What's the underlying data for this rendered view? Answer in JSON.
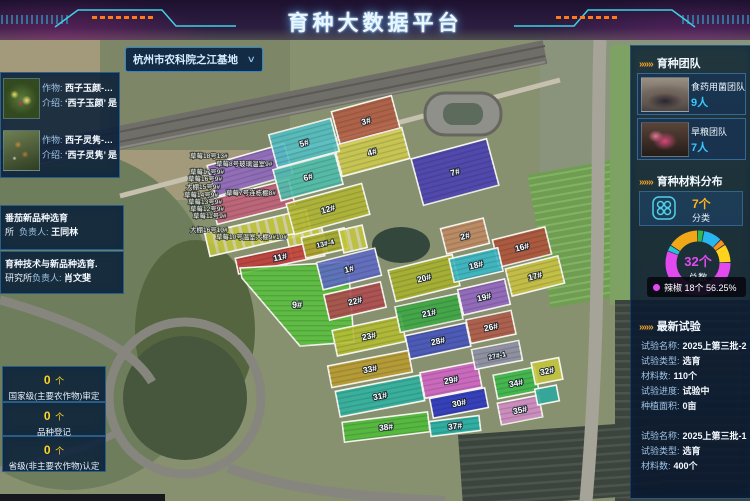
{
  "header": {
    "title": "育种大数据平台"
  },
  "base_selector": {
    "value": "杭州市农科院之江基地",
    "chevron": "∨"
  },
  "icons": {
    "section_marker": "»»»"
  },
  "left": {
    "crops": [
      {
        "crop_label": "作物:",
        "name": "西子玉颜-…",
        "intro_label": "介绍:",
        "intro": "‘西子玉颜’ 是…"
      },
      {
        "crop_label": "作物:",
        "name": "西子灵隽-…",
        "intro_label": "介绍:",
        "intro": "‘西子灵隽’ 是…"
      }
    ],
    "projects": [
      {
        "title": "番茄新品种选育",
        "org": "所",
        "leader_label": "负责人:",
        "leader": "王同林"
      },
      {
        "title": "育种技术与新品种选育.",
        "org": "研究所",
        "leader_label": "负责人:",
        "leader": "肖文斐"
      }
    ],
    "stats": [
      {
        "value": "0",
        "unit": "个",
        "label": "国家级(主要农作物)审定"
      },
      {
        "value": "0",
        "unit": "个",
        "label": "品种登记"
      },
      {
        "value": "0",
        "unit": "个",
        "label": "省级(非主要农作物)认定"
      }
    ]
  },
  "right": {
    "teams": {
      "title": "育种团队",
      "items": [
        {
          "name": "食药用菌团队",
          "count": "9人"
        },
        {
          "name": "旱粮团队",
          "count": "7人"
        }
      ]
    },
    "materials": {
      "title": "育种材料分布",
      "categories_count": "7个",
      "categories_label": "分类",
      "total": "32个",
      "total_label": "总数",
      "tooltip_text": "辣椒 18个  56.25%"
    },
    "experiments": {
      "title": "最新试验",
      "items": [
        {
          "fields": [
            {
              "l": "试验名称:",
              "v": "2025上第三批-2"
            },
            {
              "l": "试验类型:",
              "v": "选育"
            },
            {
              "l": "材料数:",
              "v": "110个"
            },
            {
              "l": "试验进度:",
              "v": "试验中"
            },
            {
              "l": "种植面积:",
              "v": "0亩"
            }
          ]
        },
        {
          "fields": [
            {
              "l": "试验名称:",
              "v": "2025上第三批-1"
            },
            {
              "l": "试验类型:",
              "v": "选育"
            },
            {
              "l": "材料数:",
              "v": "400个"
            }
          ]
        }
      ]
    }
  },
  "chart_data": {
    "type": "pie",
    "title": "育种材料分布",
    "total": 32,
    "total_label": "总数",
    "categories_count": 7,
    "legend_position": "tooltip-only",
    "segments": [
      {
        "name": "",
        "value": 1,
        "color": "#2eb84d"
      },
      {
        "name": "",
        "value": 3,
        "color": "#29b5f0"
      },
      {
        "name": "",
        "value": 1,
        "color": "#f7931e"
      },
      {
        "name": "",
        "value": 3,
        "color": "#ffd21e"
      },
      {
        "name": "辣椒",
        "value": 18,
        "color": "#e24af0",
        "percent": "56.25%"
      },
      {
        "name": "",
        "value": 1,
        "color": "#29c0d8"
      },
      {
        "name": "",
        "value": 5,
        "color": "#f0a818"
      }
    ]
  },
  "map": {
    "parcels": [
      {
        "id": "greenhouse-purple",
        "x": 250,
        "y": 170,
        "w": 80,
        "h": 32,
        "r": -16,
        "c": "#9068c0",
        "l": ""
      },
      {
        "id": "greenhouse-pink",
        "x": 253,
        "y": 202,
        "w": 80,
        "h": 26,
        "r": -14,
        "c": "#c4607c",
        "l": ""
      },
      {
        "id": "strip-beds-a",
        "x": 258,
        "y": 233,
        "w": 104,
        "h": 24,
        "r": -13,
        "c": "strips",
        "l": ""
      },
      {
        "id": "strip-beds-c",
        "x": 307,
        "y": 244,
        "w": 36,
        "h": 26,
        "r": -13,
        "c": "strips",
        "l": ""
      },
      {
        "id": "p11",
        "x": 280,
        "y": 257,
        "w": 88,
        "h": 16,
        "r": -12,
        "c": "#c23b3b",
        "l": "11#"
      },
      {
        "id": "p9",
        "poly": "240,268 348,262 354,342 300,346 242,278",
        "c": "#57c23c",
        "l": "9#",
        "lx": 297,
        "ly": 308
      },
      {
        "id": "p12",
        "x": 328,
        "y": 209,
        "w": 78,
        "h": 32,
        "r": -15,
        "c": "#b3b733",
        "l": "12#"
      },
      {
        "id": "p13-4",
        "x": 325,
        "y": 243,
        "w": 44,
        "h": 21,
        "r": -13,
        "c": "#a8ad2e",
        "l": "13#-4"
      },
      {
        "id": "strip-beds-d",
        "x": 353,
        "y": 239,
        "w": 24,
        "h": 23,
        "r": -13,
        "c": "strips",
        "l": ""
      },
      {
        "id": "p1",
        "x": 349,
        "y": 269,
        "w": 60,
        "h": 28,
        "r": -14,
        "c": "#5f6ac8",
        "l": "1#"
      },
      {
        "id": "p22",
        "x": 355,
        "y": 301,
        "w": 58,
        "h": 26,
        "r": -13,
        "c": "#b24a50",
        "l": "22#"
      },
      {
        "id": "p23",
        "x": 369,
        "y": 336,
        "w": 70,
        "h": 26,
        "r": -12,
        "c": "#b5bd32",
        "l": "23#"
      },
      {
        "id": "p33",
        "x": 370,
        "y": 369,
        "w": 82,
        "h": 22,
        "r": -11,
        "c": "#bb9c30",
        "l": "33#"
      },
      {
        "id": "p31",
        "x": 380,
        "y": 396,
        "w": 86,
        "h": 26,
        "r": -11,
        "c": "#2fb3a3",
        "l": "31#"
      },
      {
        "id": "p38",
        "x": 386,
        "y": 427,
        "w": 86,
        "h": 20,
        "r": -7,
        "c": "#50bd3a",
        "l": "38#"
      },
      {
        "id": "p20",
        "x": 424,
        "y": 278,
        "w": 66,
        "h": 32,
        "r": -14,
        "c": "#aab32f",
        "l": "20#"
      },
      {
        "id": "p21",
        "x": 429,
        "y": 313,
        "w": 64,
        "h": 26,
        "r": -12,
        "c": "#3ba844",
        "l": "21#"
      },
      {
        "id": "p28",
        "x": 438,
        "y": 341,
        "w": 62,
        "h": 24,
        "r": -12,
        "c": "#4653c0",
        "l": "28#"
      },
      {
        "id": "p29",
        "x": 451,
        "y": 380,
        "w": 58,
        "h": 26,
        "r": -11,
        "c": "#d464c8",
        "l": "29#"
      },
      {
        "id": "p30",
        "x": 459,
        "y": 403,
        "w": 56,
        "h": 20,
        "r": -11,
        "c": "#2b35c4",
        "l": "30#"
      },
      {
        "id": "p37",
        "x": 455,
        "y": 426,
        "w": 50,
        "h": 15,
        "r": -7,
        "c": "#24b2a8",
        "l": "37#"
      },
      {
        "id": "p2",
        "x": 465,
        "y": 236,
        "w": 44,
        "h": 26,
        "r": -14,
        "c": "#c28a64",
        "l": "2#"
      },
      {
        "id": "p16",
        "x": 522,
        "y": 247,
        "w": 54,
        "h": 28,
        "r": -14,
        "c": "#b1523a",
        "l": "16#"
      },
      {
        "id": "p17",
        "x": 535,
        "y": 276,
        "w": 54,
        "h": 28,
        "r": -14,
        "c": "#ccc343",
        "l": "17#"
      },
      {
        "id": "p18",
        "x": 476,
        "y": 265,
        "w": 50,
        "h": 24,
        "r": -13,
        "c": "#38b9c9",
        "l": "18#"
      },
      {
        "id": "p19",
        "x": 484,
        "y": 297,
        "w": 48,
        "h": 26,
        "r": -13,
        "c": "#9465c4",
        "l": "19#"
      },
      {
        "id": "p26",
        "x": 491,
        "y": 327,
        "w": 46,
        "h": 24,
        "r": -12,
        "c": "#b25a4a",
        "l": "26#"
      },
      {
        "id": "p27-1",
        "x": 497,
        "y": 355,
        "w": 48,
        "h": 20,
        "r": -11,
        "c": "#9191a8",
        "l": "27#-1"
      },
      {
        "id": "p34",
        "x": 516,
        "y": 383,
        "w": 42,
        "h": 24,
        "r": -11,
        "c": "#3cba4a",
        "l": "34#"
      },
      {
        "id": "p35",
        "x": 520,
        "y": 410,
        "w": 42,
        "h": 22,
        "r": -11,
        "c": "#d48cc8",
        "l": "35#"
      },
      {
        "id": "p32",
        "x": 547,
        "y": 371,
        "w": 28,
        "h": 22,
        "r": -11,
        "c": "#c6c63e",
        "l": "32#"
      },
      {
        "id": "p36",
        "x": 547,
        "y": 395,
        "w": 22,
        "h": 16,
        "r": -11,
        "c": "#2aa89e",
        "l": ""
      },
      {
        "id": "p3",
        "x": 366,
        "y": 121,
        "w": 62,
        "h": 36,
        "r": -15,
        "c": "#b45c44",
        "l": "3#"
      },
      {
        "id": "p4",
        "x": 372,
        "y": 152,
        "w": 70,
        "h": 32,
        "r": -15,
        "c": "#cfcb4e",
        "l": "4#"
      },
      {
        "id": "p5",
        "x": 304,
        "y": 143,
        "w": 64,
        "h": 34,
        "r": -15,
        "c": "#52bfc4",
        "l": "5#"
      },
      {
        "id": "p6",
        "x": 308,
        "y": 177,
        "w": 64,
        "h": 32,
        "r": -15,
        "c": "#4fc0ae",
        "l": "6#"
      },
      {
        "id": "p7",
        "x": 455,
        "y": 172,
        "w": 78,
        "h": 48,
        "r": -15,
        "c": "#4a3fb5",
        "l": "7#"
      }
    ],
    "tiny_labels": [
      {
        "t": "草莓18号13#",
        "x": 190,
        "y": 158
      },
      {
        "t": "草莓8号玻璃温室9#",
        "x": 216,
        "y": 166
      },
      {
        "t": "草莓17号9#",
        "x": 190,
        "y": 174
      },
      {
        "t": "草莓16号9#",
        "x": 188,
        "y": 181
      },
      {
        "t": "大棚15号9#",
        "x": 186,
        "y": 189
      },
      {
        "t": "草莓14号9#",
        "x": 184,
        "y": 197
      },
      {
        "t": "草莓7号连栋棚8#",
        "x": 226,
        "y": 195
      },
      {
        "t": "草莓13号9#",
        "x": 188,
        "y": 204
      },
      {
        "t": "草莓12号9#",
        "x": 190,
        "y": 211
      },
      {
        "t": "草莓11号9#",
        "x": 193,
        "y": 218
      },
      {
        "t": "大棚16号10#",
        "x": 190,
        "y": 232
      },
      {
        "t": "草莓10号温室大棚9#10#",
        "x": 216,
        "y": 239
      }
    ]
  }
}
